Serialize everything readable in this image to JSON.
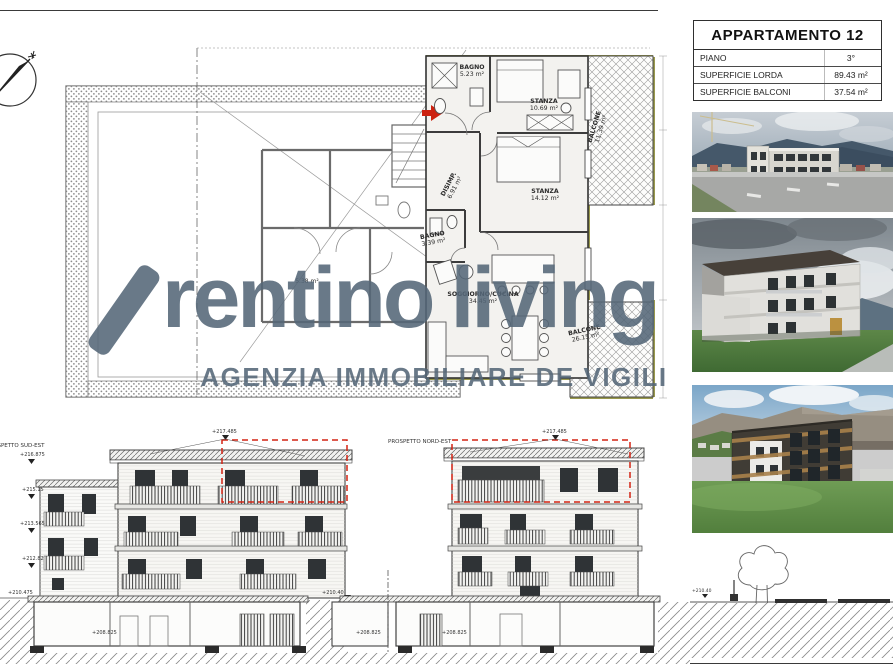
{
  "sheet": {
    "title_block": {
      "title": "APPARTAMENTO 12",
      "rows": [
        {
          "label": "PIANO",
          "value": "3°"
        },
        {
          "label": "SUPERFICIE LORDA",
          "value": "89.43 m²"
        },
        {
          "label": "SUPERFICIE BALCONI",
          "value": "37.54 m²"
        }
      ]
    },
    "watermark": {
      "brand_first": "rentino",
      "brand_second": "living",
      "subtitle": "AGENZIA IMMOBILIARE DE VIGILI",
      "color": "#546777"
    },
    "plan": {
      "rooms": [
        {
          "name": "BAGNO",
          "area": "5.23 m²"
        },
        {
          "name": "STANZA",
          "area": "10.69 m²"
        },
        {
          "name": "BALCONE",
          "area": "11.39 m²"
        },
        {
          "name": "DISIMP.",
          "area": "6.91 m²"
        },
        {
          "name": "STANZA",
          "area": "14.12 m²"
        },
        {
          "name": "BAGNO",
          "area": "3.39 m²"
        },
        {
          "name": "SOGGIORNO/CUCINA",
          "area": "34.45 m²"
        },
        {
          "name": "BALCONE",
          "area": "26.15 m²"
        }
      ],
      "neighbor_area": "5.38 m²"
    },
    "elevations": {
      "left": {
        "label": "PROSPETTO SUD-EST",
        "top_marker": "+217.485",
        "side_markers": [
          "+216.875",
          "+215.15",
          "+213.565",
          "+212.82",
          "+210.475"
        ],
        "base_marker": "+208.825"
      },
      "right": {
        "label": "PROSPETTO NORD-EST",
        "top_marker": "+217.485",
        "side_markers": [
          "+210.40"
        ],
        "base_markers": [
          "+208.825",
          "+208.825"
        ]
      },
      "site_marker": "+210.40"
    },
    "colors": {
      "red": "#cc2211",
      "insulation": "#9a9a4d"
    }
  }
}
